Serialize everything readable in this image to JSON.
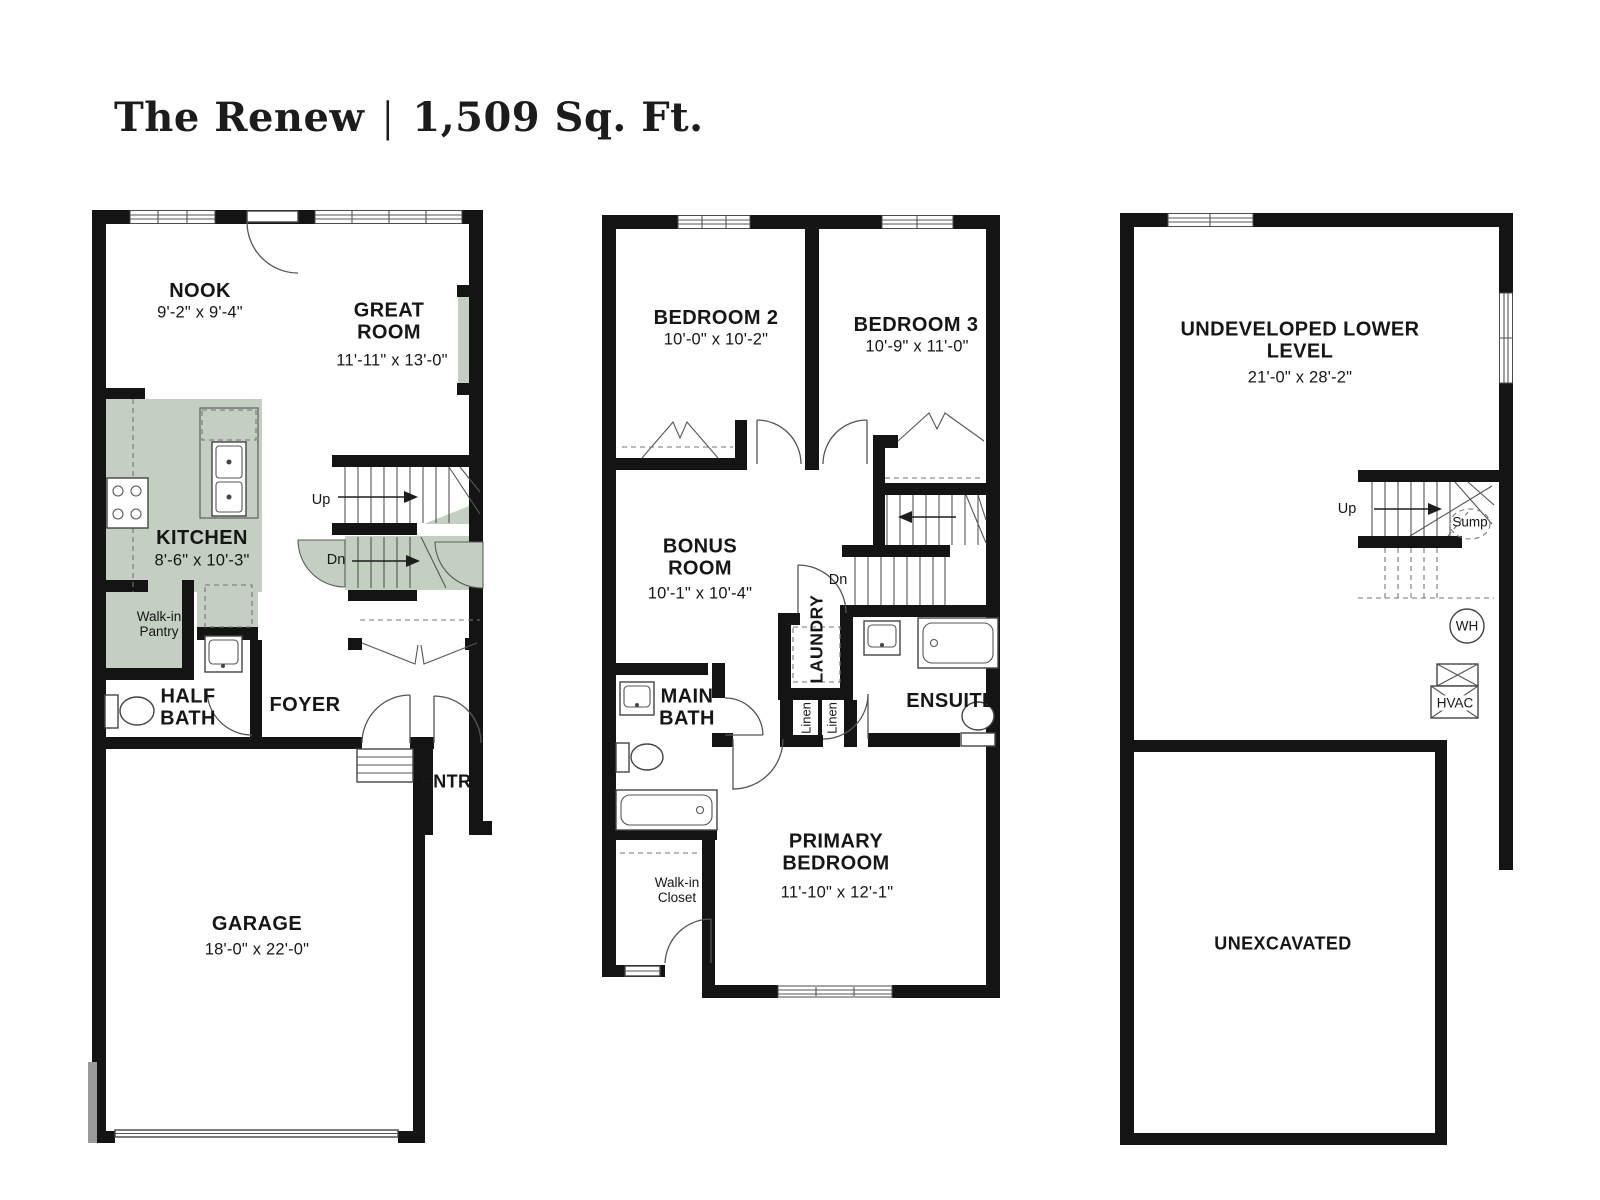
{
  "title": {
    "name": "The Renew",
    "separator": "|",
    "area": "1,509 Sq. Ft."
  },
  "colors": {
    "accent_green": "#c3cfc0",
    "wall_black": "#141414"
  },
  "main_floor": {
    "nook": {
      "label": "NOOK",
      "dim": "9'-2\" x 9'-4\""
    },
    "great_room": {
      "label": "GREAT ROOM",
      "dim": "11'-11\" x 13'-0\""
    },
    "kitchen": {
      "label": "KITCHEN",
      "dim": "8'-6\" x 10'-3\""
    },
    "pantry": {
      "label": "Walk-in Pantry"
    },
    "half_bath": {
      "label": "HALF BATH"
    },
    "foyer": {
      "label": "FOYER"
    },
    "entry": {
      "label": "ENTRY"
    },
    "garage": {
      "label": "GARAGE",
      "dim": "18'-0\" x 22'-0\""
    },
    "up_label": "Up",
    "dn_label": "Dn"
  },
  "upper_floor": {
    "bedroom2": {
      "label": "BEDROOM 2",
      "dim": "10'-0\" x 10'-2\""
    },
    "bedroom3": {
      "label": "BEDROOM 3",
      "dim": "10'-9\" x 11'-0\""
    },
    "bonus_room": {
      "label": "BONUS ROOM",
      "dim": "10'-1\" x 10'-4\""
    },
    "laundry": {
      "label": "LAUNDRY"
    },
    "linen_left": {
      "label": "Linen"
    },
    "linen_right": {
      "label": "Linen"
    },
    "main_bath": {
      "label": "MAIN BATH"
    },
    "ensuite": {
      "label": "ENSUITE"
    },
    "primary_bedroom": {
      "label": "PRIMARY BEDROOM",
      "dim": "11'-10\" x 12'-1\""
    },
    "walk_in_closet": {
      "label": "Walk-in Closet"
    },
    "dn_label": "Dn"
  },
  "lower_floor": {
    "undeveloped": {
      "label": "UNDEVELOPED LOWER LEVEL",
      "dim": "21'-0\" x 28'-2\""
    },
    "unexcavated": {
      "label": "UNEXCAVATED"
    },
    "up_label": "Up",
    "sump_label": "Sump",
    "wh_label": "WH",
    "hvac_label": "HVAC"
  }
}
